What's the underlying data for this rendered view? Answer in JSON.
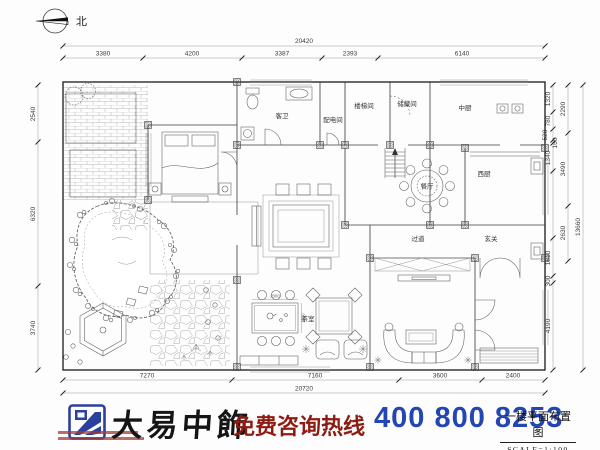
{
  "meta": {
    "north_label": "北"
  },
  "dimensions": {
    "top": {
      "total": "20420",
      "segments": [
        "3380",
        "4200",
        "3387",
        "2393",
        "6140"
      ]
    },
    "bottom": {
      "total": "20720",
      "segments": [
        "7270",
        "7160",
        "3600",
        "2400"
      ]
    },
    "left": {
      "segments": [
        "2540",
        "6320",
        "3740"
      ]
    },
    "right": {
      "inner": [
        "1320",
        "780",
        "520",
        "160",
        "1340",
        "1810",
        "300",
        "4190"
      ],
      "mid": [
        "2290",
        "3490",
        "2630"
      ],
      "total": "13660"
    }
  },
  "rooms": {
    "guest_bath": "客卫",
    "power_room": "配电间",
    "stairwell": "楼梯间",
    "storage": "储藏间",
    "chinese_kitchen": "中厨",
    "dining": "餐厅",
    "western_kitchen": "西厨",
    "corridor": "过道",
    "foyer": "玄关",
    "tea_room": "茶室"
  },
  "annotations": {
    "tea_table_width": "2000",
    "tea_table_depth": "1000"
  },
  "banner": {
    "brand": "大易中飾",
    "hotline_label": "免费咨询热线",
    "phone": "400 800 8253",
    "drawing_title": "一楼平面布置图",
    "scale": "SCALE=1:100",
    "colors": {
      "brand_blue": "#2b3f9e",
      "hotline_red": "#8e1b12",
      "phone_blue": "#2446b2"
    }
  }
}
